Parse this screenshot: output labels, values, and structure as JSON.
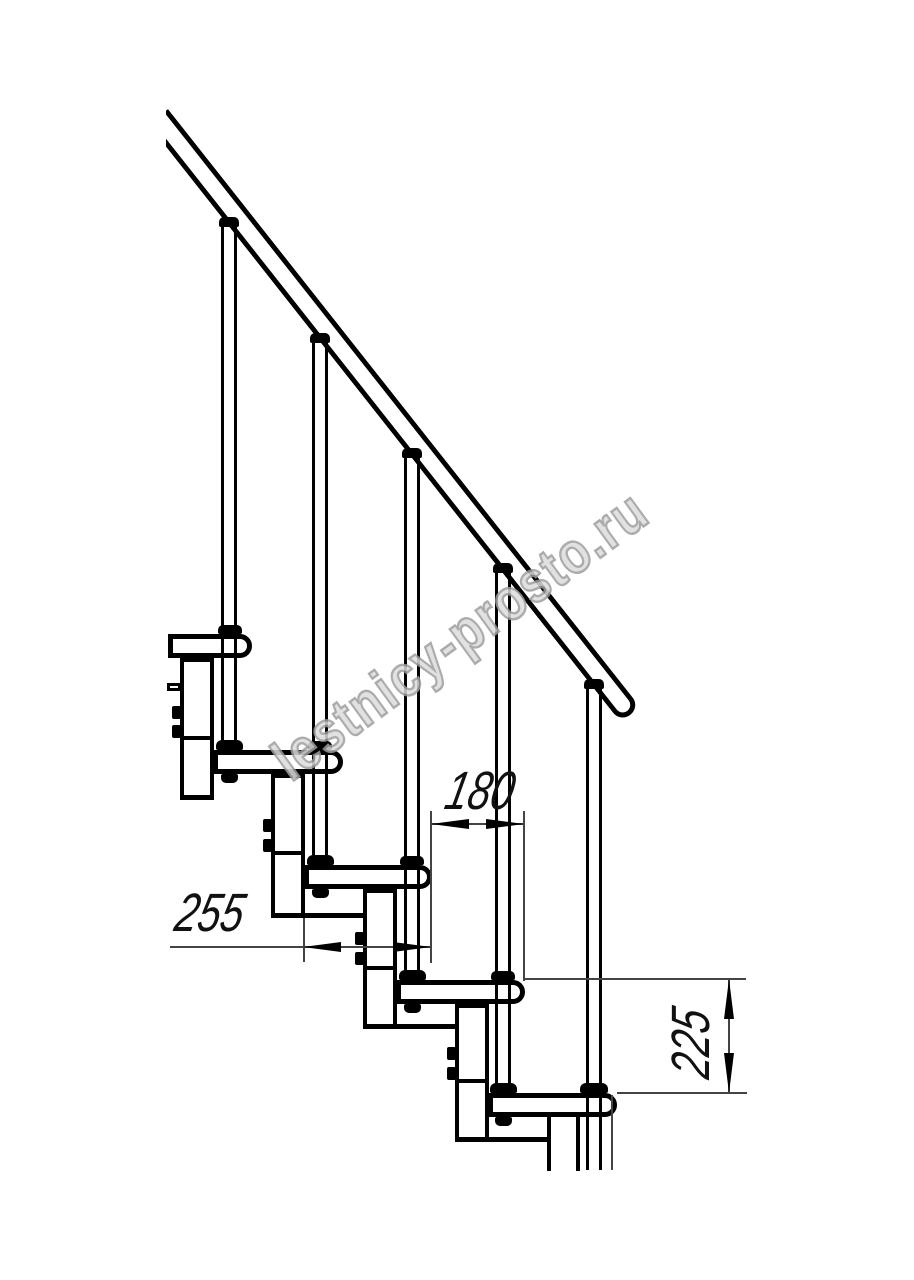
{
  "watermark": {
    "text": "lestnicy-prosto.ru"
  },
  "dimensions": {
    "tread_depth_label": "255",
    "step_spacing_label": "180",
    "riser_height_label": "225"
  },
  "structure": {
    "type": "modular staircase side elevation",
    "tread_count": 5,
    "baluster_count": 5,
    "has_handrail": true,
    "line_color": "#000000",
    "background_color": "#ffffff",
    "watermark_color": "#9e9e9e"
  }
}
